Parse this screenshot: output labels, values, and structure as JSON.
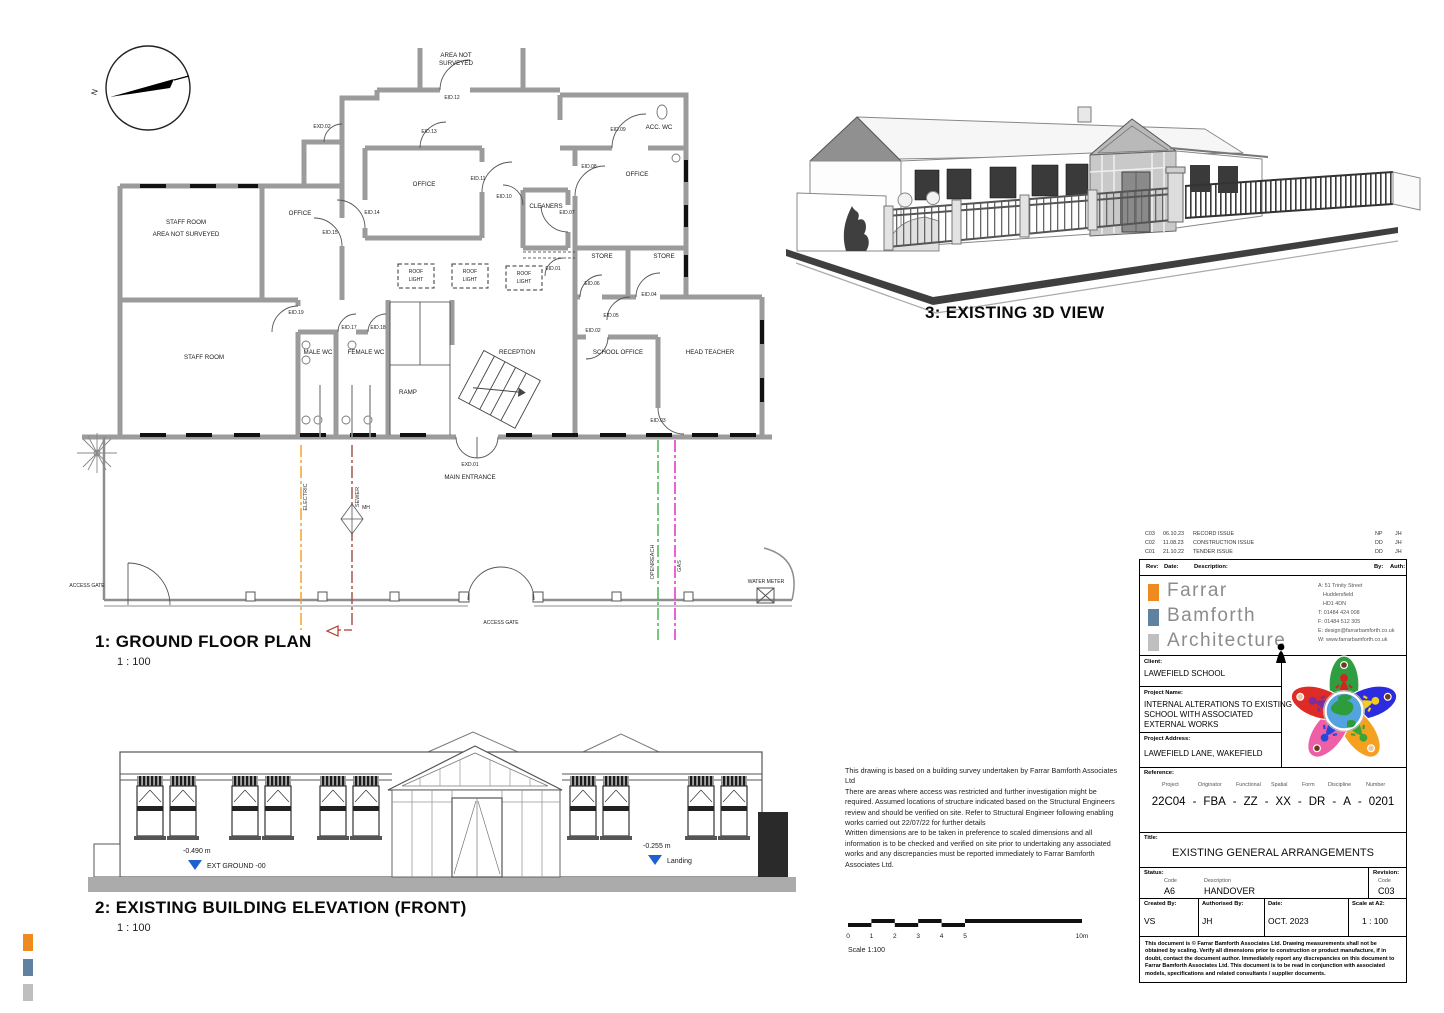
{
  "plan": {
    "title": "1: GROUND FLOOR PLAN",
    "scale": "1 : 100",
    "labels": {
      "area1": "AREA NOT",
      "area2": "SURVEYED",
      "staff": "STAFF ROOM",
      "ans": "AREA NOT SURVEYED",
      "office": "OFFICE",
      "accwc": "ACC. WC",
      "cleaners": "CLEANERS",
      "store": "STORE",
      "male": "MALE WC",
      "female": "FEMALE WC",
      "ramp": "RAMP",
      "reception": "RECEPTION",
      "school": "SCHOOL OFFICE",
      "head": "HEAD TEACHER",
      "entrance": "MAIN ENTRANCE",
      "roof": "ROOF",
      "light": "LIGHT",
      "gate": "ACCESS GATE",
      "water": "WATER METER",
      "electric": "ELECTRIC",
      "sewer": "SEWER",
      "openreach": "OPENREACH",
      "gas": "GAS",
      "mh": "MH",
      "north": "N"
    },
    "doors": {
      "x01": "EXD.01",
      "x02": "EXD.02",
      "d01": "EID.01",
      "d02": "EID.02",
      "d03": "EID.03",
      "d04": "EID.04",
      "d05": "EID.05",
      "d06": "EID.06",
      "d07": "EID.07",
      "d08": "EID.08",
      "d09": "EID.09",
      "d10": "EID.10",
      "d11": "EID.11",
      "d12": "EID.12",
      "d13": "EID.13",
      "d14": "EID.14",
      "d15": "EID.15",
      "d17": "EID.17",
      "d18": "EID.18",
      "d19": "EID.19"
    }
  },
  "elevation": {
    "title": "2: EXISTING BUILDING ELEVATION (FRONT)",
    "scale": "1 : 100",
    "levels": {
      "eg_val": "-0.490 m",
      "eg_label": "EXT GROUND -00",
      "land_val": "-0.255 m",
      "land_label": "Landing"
    }
  },
  "view3d": {
    "title": "3: EXISTING 3D VIEW"
  },
  "notes": {
    "text": "This drawing is based on a building survey undertaken by Farrar Bamforth Associates Ltd\nThere are areas where access was restricted and further investigation might be required. Assumed locations of structure indicated based on the Structural Engineers review and should be verified on site. Refer to Structural Engineer following enabling works carried out 22/07/22 for further details\nWritten dimensions are to be taken in preference to scaled dimensions and all information is to be checked and verified on site prior to undertaking any associated works and any discrepancies must be reported immediately to Farrar Bamforth Associates Ltd."
  },
  "scalebar": {
    "ticks": [
      "0",
      "1",
      "2",
      "3",
      "4",
      "5",
      "10m"
    ],
    "label": "Scale 1:100"
  },
  "titleblock": {
    "revisions": [
      {
        "rev": "C03",
        "date": "06.10.23",
        "desc": "RECORD ISSUE",
        "by": "NP",
        "auth": "JH"
      },
      {
        "rev": "C02",
        "date": "11.08.23",
        "desc": "CONSTRUCTION ISSUE",
        "by": "DD",
        "auth": "JH"
      },
      {
        "rev": "C01",
        "date": "21.10.22",
        "desc": "TENDER ISSUE",
        "by": "DD",
        "auth": "JH"
      }
    ],
    "rev_headers": {
      "rev": "Rev:",
      "date": "Date:",
      "desc": "Description:",
      "by": "By:",
      "auth": "Auth:"
    },
    "firm": {
      "name1": "Farrar",
      "name2": "Bamforth",
      "name3": "Architecture",
      "address": [
        "A: 51 Trinity Street",
        "Huddersfield",
        "HD1 4DN",
        "T: 01484 424 008",
        "F: 01484 512 305",
        "E: design@farrarbamforth.co.uk",
        "W: www.farrarbamforth.co.uk"
      ]
    },
    "client_label": "Client:",
    "client": "LAWEFIELD SCHOOL",
    "project_name_label": "Project Name:",
    "project_name_1": "INTERNAL ALTERATIONS TO EXISTING",
    "project_name_2": "SCHOOL WITH ASSOCIATED",
    "project_name_3": "EXTERNAL WORKS",
    "project_address_label": "Project Address:",
    "project_address": "LAWEFIELD LANE, WAKEFIELD",
    "reference_label": "Reference:",
    "reference": {
      "headers": [
        "Project",
        "Originator",
        "Functional",
        "Spatial",
        "Form",
        "Discipline",
        "Number"
      ],
      "values": [
        "22C04",
        "FBA",
        "ZZ",
        "XX",
        "DR",
        "A",
        "0201"
      ],
      "sep": "-"
    },
    "title_label": "Title:",
    "title": "EXISTING GENERAL ARRANGEMENTS",
    "status_label": "Status:",
    "status_code_header": "Code",
    "status_desc_header": "Description",
    "status_code": "A6",
    "status_desc": "HANDOVER",
    "revision_label": "Revision:",
    "revision_code_header": "Code",
    "revision_code": "C03",
    "created_by_label": "Created By:",
    "created_by": "VS",
    "authorised_by_label": "Authorised By:",
    "authorised_by": "JH",
    "date_label": "Date:",
    "date": "OCT. 2023",
    "scale_label": "Scale at A2:",
    "scale": "1 : 100",
    "disclaimer": "This document is © Farrar Bamforth Associates Ltd. Drawing measurements shall not be obtained by scaling. Verify all dimensions prior to construction or product manufacture, if in doubt, contact the document author. Immediately report any discrepancies on this document to Farrar Bamforth Associates Ltd. This document is to be read in conjunction with associated models, specifications and related consultants / supplier documents."
  },
  "colors": {
    "orange": "#EF8A1F",
    "steel": "#5E82A0",
    "gray": "#BDBFC1",
    "electric": "#F59A23",
    "sewer": "#9E4B43",
    "openreach": "#3FAF46",
    "gas": "#E020C0",
    "level_blue": "#1F5FD0"
  }
}
